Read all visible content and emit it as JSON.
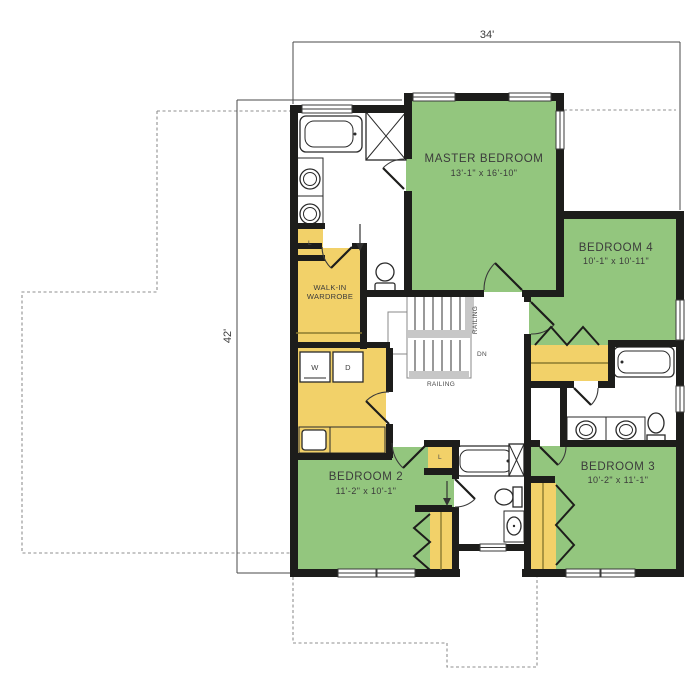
{
  "dimensions": {
    "top_width": "34'",
    "left_height": "42'"
  },
  "rooms": {
    "master_bedroom": {
      "name": "MASTER BEDROOM",
      "size": "13'-1\" x 16'-10\""
    },
    "bedroom_4": {
      "name": "BEDROOM 4",
      "size": "10'-1\" x 10'-11\""
    },
    "bedroom_2": {
      "name": "BEDROOM 2",
      "size": "11'-2\" x 10'-1\""
    },
    "bedroom_3": {
      "name": "BEDROOM 3",
      "size": "10'-2\" x 11'-1\""
    },
    "walk_in_wardrobe": {
      "line1": "WALK-IN",
      "line2": "WARDROBE"
    }
  },
  "stairs": {
    "railing_right": "RAILING",
    "railing_bottom": "RAILING",
    "direction": "DN"
  },
  "appliances": {
    "washer": "W",
    "dryer": "D"
  },
  "closets": {
    "linen_master": "L",
    "linen_hall": "L"
  },
  "colors": {
    "bedroom_fill": "#93C67E",
    "closet_fill": "#F2D169",
    "wall": "#1D1D1B",
    "fixture_line": "#2A2A2A",
    "railing_gray": "#C7C7C7",
    "dimension_line": "#4A4A4A",
    "dashed_outline": "#8F8F8F",
    "label_text": "#3B3B3B"
  }
}
